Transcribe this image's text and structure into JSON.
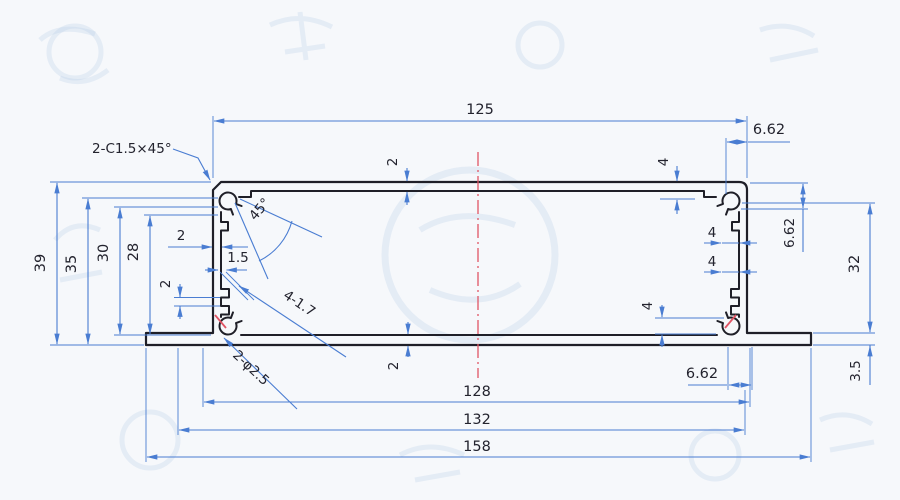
{
  "drawing": {
    "chamfer_note": "2-C1.5×45°",
    "angle_note": "45°",
    "slot_note": "4-1.7",
    "hole_note": "2-φ2.5"
  },
  "dims": {
    "top_width": "125",
    "offset_top_right": "6.62",
    "offset_right": "6.62",
    "offset_bottom_right": "6.62",
    "boss_top_right": "4",
    "wall_step_upper": "4",
    "wall_step_lower": "4",
    "boss_bottom_right": "4",
    "cavity_height": "32",
    "flange_thickness": "3.5",
    "overall_height": "39",
    "height_to_slot": "35",
    "inner_height_upper": "30",
    "inner_height_lower": "28",
    "wall_left": "2",
    "groove_left": "2",
    "wall_top": "2",
    "wall_bottom": "2",
    "slot_width": "1.5",
    "bottom_width_inner": "128",
    "bottom_width_mid": "132",
    "bottom_width_overall": "158"
  },
  "colors": {
    "dimension": "#4a7dd2",
    "outline": "#1f1f28",
    "centerline": "#e05565",
    "paper": "#f6f8fb",
    "watermark": "#b7cde6",
    "ink": "#23232e"
  }
}
